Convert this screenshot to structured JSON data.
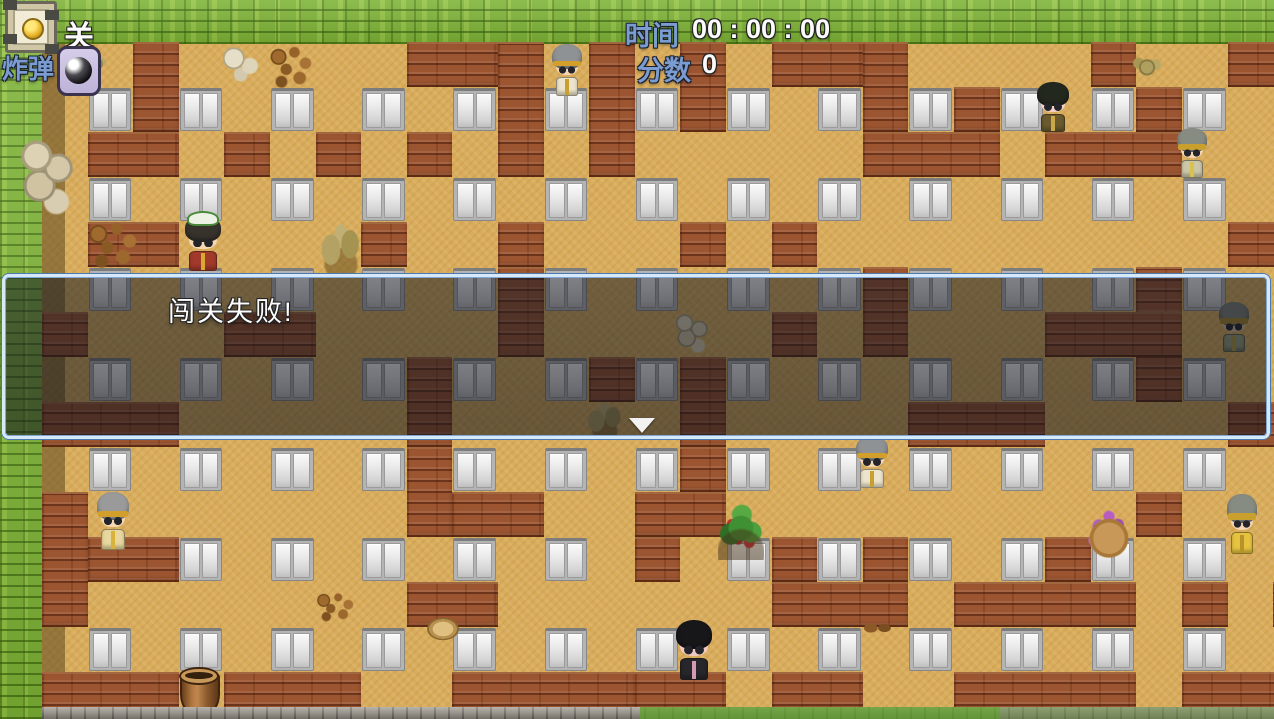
{
  "hud": {
    "level_label": "关",
    "bomb_label": "炸弹",
    "time_label": "时间",
    "time_value": "00 : 00 : 00",
    "score_label": "分数",
    "score_value": "0",
    "icons": {
      "level_icon": "lantern-panel-icon",
      "bomb_icon": "bomb-icon"
    },
    "colors": {
      "label_blue": "#7b9cd0",
      "value_white": "#fbfbfb"
    }
  },
  "dialog": {
    "text": "闯关失败!",
    "border_color": "#d7e8f8",
    "continue_indicator": "down-triangle"
  },
  "palette": {
    "grass_green": "#7db335",
    "floor_tan": "#d8ac5a",
    "brick_red": "#9c5531",
    "door_white": "#ececec",
    "shadow_olive": "rgba(58,42,12,0.42)"
  },
  "board": {
    "doors": [
      [
        1,
        1
      ],
      [
        3,
        1
      ],
      [
        5,
        1
      ],
      [
        7,
        1
      ],
      [
        9,
        1
      ],
      [
        11,
        1
      ],
      [
        13,
        1
      ],
      [
        15,
        1
      ],
      [
        17,
        1
      ],
      [
        19,
        1
      ],
      [
        21,
        1
      ],
      [
        23,
        1
      ],
      [
        25,
        1
      ],
      [
        27,
        1
      ],
      [
        1,
        3
      ],
      [
        3,
        3
      ],
      [
        5,
        3
      ],
      [
        7,
        3
      ],
      [
        9,
        3
      ],
      [
        11,
        3
      ],
      [
        13,
        3
      ],
      [
        15,
        3
      ],
      [
        17,
        3
      ],
      [
        19,
        3
      ],
      [
        21,
        3
      ],
      [
        23,
        3
      ],
      [
        25,
        3
      ],
      [
        27,
        3
      ],
      [
        1,
        5
      ],
      [
        3,
        5
      ],
      [
        5,
        5
      ],
      [
        7,
        5
      ],
      [
        9,
        5
      ],
      [
        11,
        5
      ],
      [
        13,
        5
      ],
      [
        15,
        5
      ],
      [
        17,
        5
      ],
      [
        19,
        5
      ],
      [
        21,
        5
      ],
      [
        23,
        5
      ],
      [
        25,
        5
      ],
      [
        1,
        7
      ],
      [
        3,
        7
      ],
      [
        5,
        7
      ],
      [
        7,
        7
      ],
      [
        9,
        7
      ],
      [
        11,
        7
      ],
      [
        13,
        7
      ],
      [
        15,
        7
      ],
      [
        17,
        7
      ],
      [
        19,
        7
      ],
      [
        21,
        7
      ],
      [
        23,
        7
      ],
      [
        25,
        7
      ],
      [
        1,
        9
      ],
      [
        3,
        9
      ],
      [
        5,
        9
      ],
      [
        7,
        9
      ],
      [
        9,
        9
      ],
      [
        11,
        9
      ],
      [
        13,
        9
      ],
      [
        15,
        9
      ],
      [
        17,
        9
      ],
      [
        19,
        9
      ],
      [
        21,
        9
      ],
      [
        23,
        9
      ],
      [
        25,
        9
      ],
      [
        27,
        9
      ],
      [
        3,
        11
      ],
      [
        5,
        11
      ],
      [
        7,
        11
      ],
      [
        9,
        11
      ],
      [
        11,
        11
      ],
      [
        15,
        11
      ],
      [
        17,
        11
      ],
      [
        19,
        11
      ],
      [
        21,
        11
      ],
      [
        23,
        11
      ],
      [
        25,
        11
      ],
      [
        27,
        11
      ],
      [
        1,
        13
      ],
      [
        3,
        13
      ],
      [
        5,
        13
      ],
      [
        7,
        13
      ],
      [
        9,
        13
      ],
      [
        11,
        13
      ],
      [
        13,
        13
      ],
      [
        15,
        13
      ],
      [
        17,
        13
      ],
      [
        19,
        13
      ],
      [
        21,
        13
      ],
      [
        23,
        13
      ],
      [
        25,
        13
      ],
      [
        27,
        13
      ]
    ],
    "bricks": [
      [
        2,
        0,
        1,
        2
      ],
      [
        8,
        0,
        2,
        1
      ],
      [
        10,
        0,
        1,
        3
      ],
      [
        12,
        0,
        1,
        3
      ],
      [
        14,
        0,
        1,
        2
      ],
      [
        16,
        0,
        2,
        1
      ],
      [
        18,
        0,
        1,
        2
      ],
      [
        23,
        0,
        1,
        1
      ],
      [
        26,
        0,
        2,
        1
      ],
      [
        20,
        1,
        1,
        1
      ],
      [
        24,
        1,
        1,
        1
      ],
      [
        1,
        2,
        2,
        1
      ],
      [
        4,
        2,
        1,
        1
      ],
      [
        6,
        2,
        1,
        1
      ],
      [
        8,
        2,
        1,
        1
      ],
      [
        18,
        2,
        3,
        1
      ],
      [
        22,
        2,
        3,
        1
      ],
      [
        1,
        4,
        2,
        1
      ],
      [
        7,
        4,
        1,
        1
      ],
      [
        10,
        4,
        1,
        1
      ],
      [
        14,
        4,
        1,
        1
      ],
      [
        16,
        4,
        1,
        1
      ],
      [
        26,
        4,
        2,
        1
      ],
      [
        10,
        5,
        1,
        2
      ],
      [
        18,
        5,
        1,
        2
      ],
      [
        24,
        5,
        1,
        3
      ],
      [
        0,
        6,
        1,
        1
      ],
      [
        4,
        6,
        2,
        1
      ],
      [
        16,
        6,
        1,
        1
      ],
      [
        22,
        6,
        3,
        1
      ],
      [
        8,
        7,
        1,
        2
      ],
      [
        12,
        7,
        1,
        1
      ],
      [
        14,
        7,
        1,
        2
      ],
      [
        0,
        8,
        3,
        1
      ],
      [
        19,
        8,
        3,
        1
      ],
      [
        26,
        8,
        2,
        1
      ],
      [
        8,
        9,
        1,
        2
      ],
      [
        14,
        9,
        1,
        1
      ],
      [
        0,
        10,
        1,
        3
      ],
      [
        9,
        10,
        2,
        1
      ],
      [
        13,
        10,
        2,
        1
      ],
      [
        24,
        10,
        1,
        1
      ],
      [
        1,
        11,
        2,
        1
      ],
      [
        13,
        11,
        1,
        1
      ],
      [
        16,
        11,
        1,
        1
      ],
      [
        18,
        11,
        1,
        1
      ],
      [
        22,
        11,
        1,
        1
      ],
      [
        8,
        12,
        2,
        1
      ],
      [
        16,
        12,
        3,
        1
      ],
      [
        20,
        12,
        4,
        1
      ],
      [
        25,
        12,
        1,
        1
      ],
      [
        27,
        12,
        1,
        1
      ],
      [
        0,
        14,
        3,
        1
      ],
      [
        4,
        14,
        3,
        1
      ],
      [
        9,
        14,
        4,
        1
      ],
      [
        13,
        14,
        2,
        1
      ],
      [
        16,
        14,
        2,
        1
      ],
      [
        20,
        14,
        4,
        1
      ],
      [
        25,
        14,
        3,
        1
      ]
    ]
  },
  "characters": [
    {
      "name": "npc-soldier-top",
      "x": 551,
      "y": 44,
      "w": 32,
      "h": 52,
      "hair": "#8f9294",
      "band": "#d2a02a",
      "skin": "#f6d7b2",
      "body": "#ece4cc",
      "sash": "#c9a02e"
    },
    {
      "name": "npc-dark-fighter",
      "x": 1036,
      "y": 82,
      "w": 34,
      "h": 50,
      "hair": "#23281f",
      "band": "",
      "skin": "#f2d0c8",
      "body": "#6b5a2e",
      "sash": "#caa84a"
    },
    {
      "name": "npc-soldier-right",
      "x": 1176,
      "y": 128,
      "w": 32,
      "h": 50,
      "hair": "#878c83",
      "band": "#c9a02e",
      "skin": "#f6d7b2",
      "body": "#cdc6a8",
      "sash": "#d9c14e"
    },
    {
      "name": "npc-girl-green-hat",
      "x": 183,
      "y": 215,
      "w": 40,
      "h": 56,
      "hair": "#37322c",
      "band": "",
      "hat": "#edf3e4",
      "skin": "#f6d7b2",
      "body": "#a23a2c",
      "sash": "#d9a82e"
    },
    {
      "name": "npc-soldier-in-dialog",
      "x": 1218,
      "y": 302,
      "w": 32,
      "h": 50,
      "hair": "#7c8178",
      "band": "#a8862a",
      "skin": "#d9bd9c",
      "body": "#9aa07e",
      "sash": "#b09a40"
    },
    {
      "name": "npc-soldier-mid",
      "x": 855,
      "y": 436,
      "w": 34,
      "h": 52,
      "hair": "#8f9294",
      "band": "#d2a02a",
      "skin": "#f6d7b2",
      "body": "#ece4cc",
      "sash": "#c9a02e"
    },
    {
      "name": "npc-soldier-left",
      "x": 96,
      "y": 492,
      "w": 34,
      "h": 58,
      "hair": "#9a9a9a",
      "band": "#d2a02a",
      "skin": "#f6d7b2",
      "body": "#e8d79e",
      "sash": "#d9b23c"
    },
    {
      "name": "npc-monk-right",
      "x": 1226,
      "y": 494,
      "w": 32,
      "h": 60,
      "hair": "#878c83",
      "band": "#c9a02e",
      "skin": "#f6d7b2",
      "body": "#e6c33f",
      "sash": "#b8922a"
    },
    {
      "name": "npc-darkhair-bottom",
      "x": 674,
      "y": 620,
      "w": 40,
      "h": 60,
      "hair": "#17171a",
      "band": "",
      "skin": "#f2c9c2",
      "body": "#26262b",
      "sash": "#d49ab0"
    }
  ],
  "decorations": [
    {
      "type": "bush-dry",
      "x": 86,
      "y": 52,
      "w": 22,
      "h": 22
    },
    {
      "type": "bones",
      "x": 220,
      "y": 45,
      "w": 46,
      "h": 38
    },
    {
      "type": "pebbles",
      "x": 268,
      "y": 44,
      "w": 48,
      "h": 46
    },
    {
      "type": "stones",
      "x": 18,
      "y": 136,
      "w": 62,
      "h": 80
    },
    {
      "type": "pebbles",
      "x": 86,
      "y": 220,
      "w": 56,
      "h": 50
    },
    {
      "type": "plant-dry",
      "x": 316,
      "y": 220,
      "w": 50,
      "h": 54
    },
    {
      "type": "bush-dry",
      "x": 1130,
      "y": 52,
      "w": 34,
      "h": 28
    },
    {
      "type": "stones",
      "x": 672,
      "y": 313,
      "w": 42,
      "h": 40
    },
    {
      "type": "plant-dry",
      "x": 583,
      "y": 400,
      "w": 44,
      "h": 38
    },
    {
      "type": "berry-bush",
      "x": 718,
      "y": 502,
      "w": 46,
      "h": 58
    },
    {
      "type": "flowers",
      "x": 1084,
      "y": 506,
      "w": 50,
      "h": 52
    },
    {
      "type": "pebbles",
      "x": 314,
      "y": 592,
      "w": 44,
      "h": 30
    },
    {
      "type": "pot",
      "x": 424,
      "y": 615,
      "w": 38,
      "h": 28
    },
    {
      "type": "dirt",
      "x": 860,
      "y": 620,
      "w": 36,
      "h": 16
    },
    {
      "type": "bucket",
      "x": 180,
      "y": 672,
      "w": 40,
      "h": 44
    }
  ]
}
